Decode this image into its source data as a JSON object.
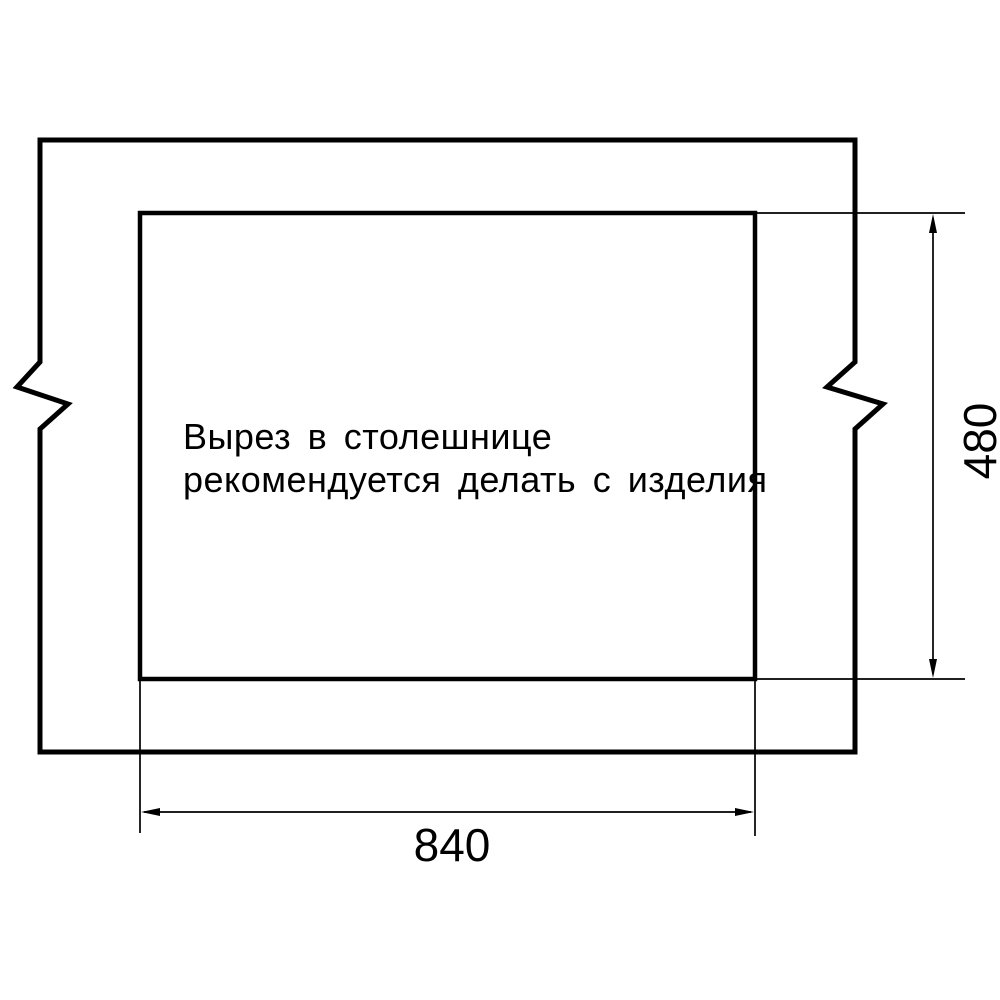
{
  "note": {
    "line1": "Вырез в столешнице",
    "line2": "рекомендуется делать с изделия"
  },
  "dimensions": {
    "cutout_width": {
      "label": "840"
    },
    "cutout_height": {
      "label": "480"
    }
  },
  "colors": {
    "line": "#000000",
    "background": "#ffffff"
  }
}
